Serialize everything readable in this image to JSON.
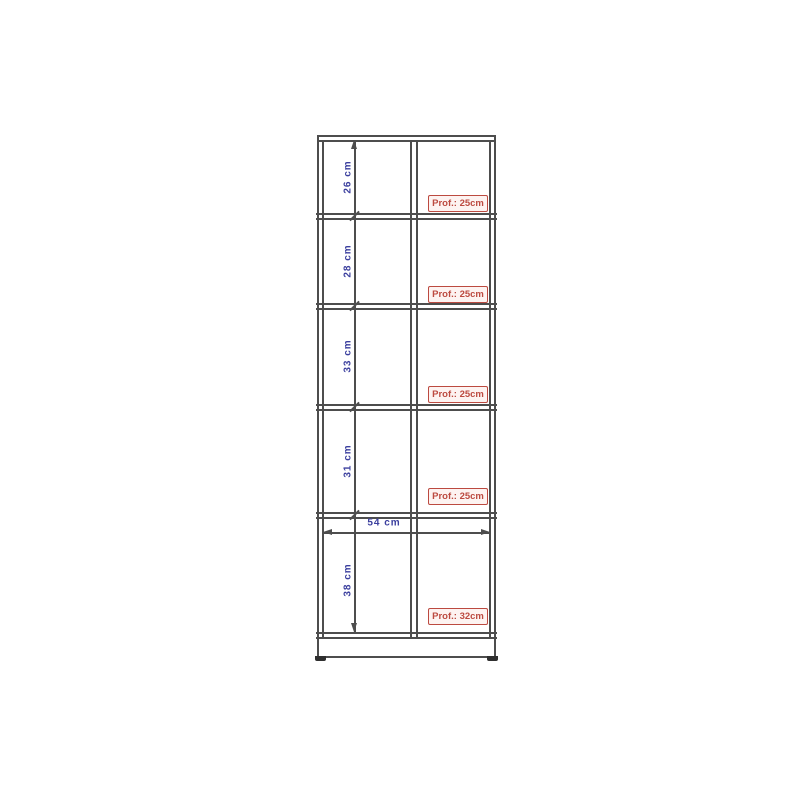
{
  "diagram": {
    "type": "furniture-dimension-drawing",
    "sections": [
      {
        "height_label": "26 cm",
        "depth_label": "Prof.: 25cm"
      },
      {
        "height_label": "28 cm",
        "depth_label": "Prof.: 25cm"
      },
      {
        "height_label": "33 cm",
        "depth_label": "Prof.: 25cm"
      },
      {
        "height_label": "31 cm",
        "depth_label": "Prof.: 25cm"
      },
      {
        "height_label": "38 cm",
        "depth_label": "Prof.: 32cm"
      }
    ],
    "width_label": "54 cm",
    "colors": {
      "outline": "#4d4d4d",
      "height_width_text": "#3b3f9e",
      "depth_text": "#bc4a40",
      "depth_box_fill": "#fdf3f1",
      "background": "#ffffff"
    }
  }
}
